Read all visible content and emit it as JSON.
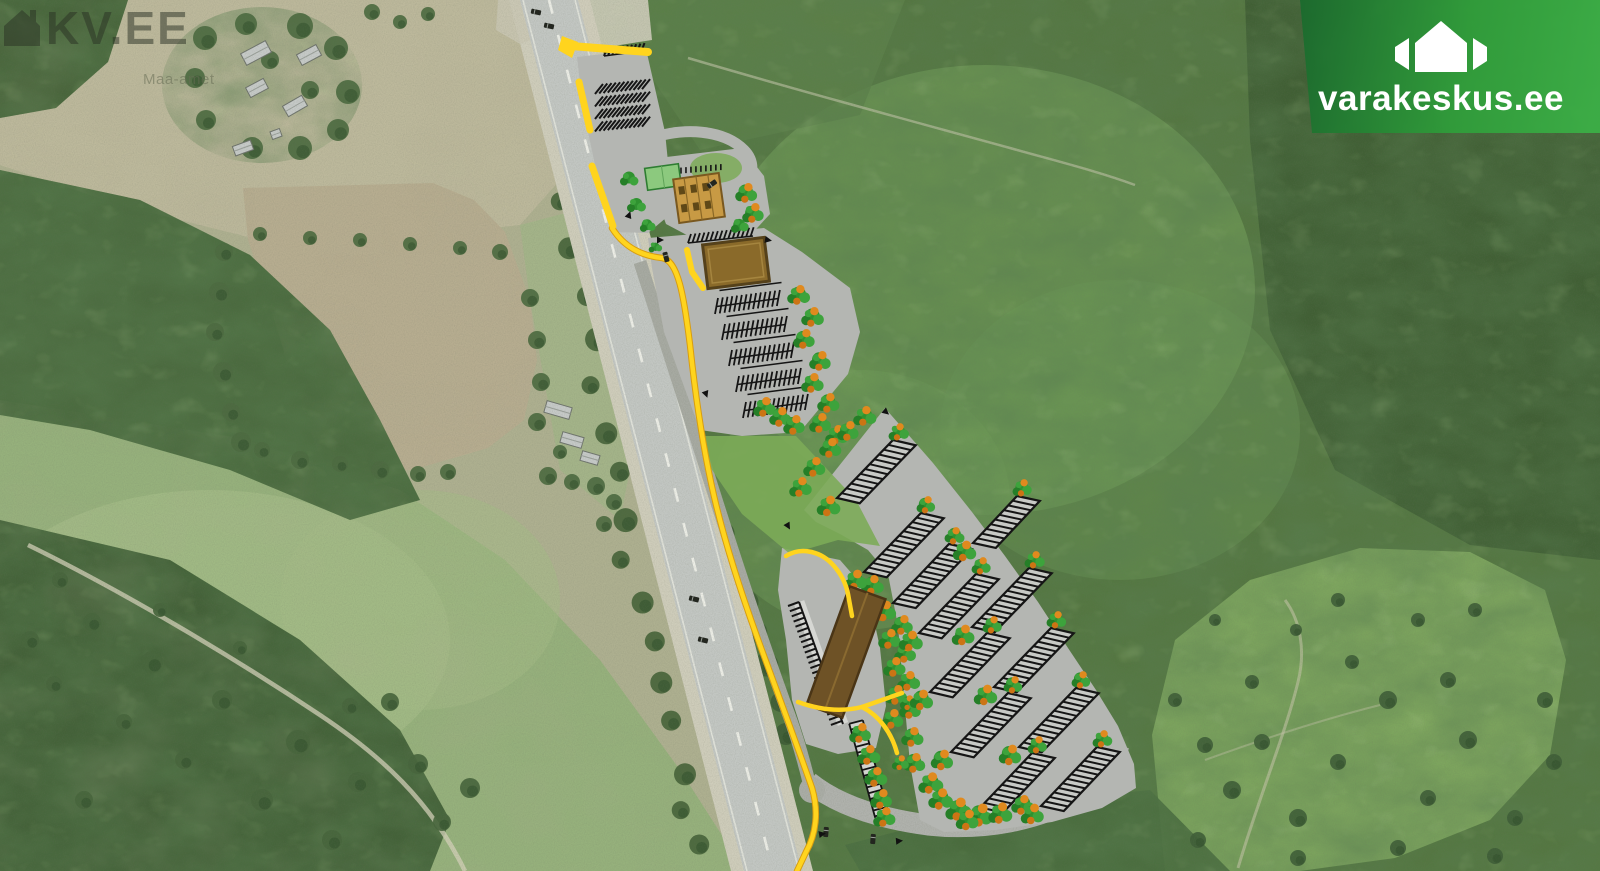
{
  "watermarks": {
    "kv_text": "KV.EE",
    "map_source_text": "Maa-amet"
  },
  "brand": {
    "name": "varakeskus.ee",
    "icon": "varakeskus-house-icon",
    "banner_gradient_start": "#1a6b2d",
    "banner_gradient_mid": "#2f9e3a",
    "banner_gradient_end": "#3bb046"
  },
  "kv": {
    "icon": "kv-house-icon",
    "color": "#2a3124"
  },
  "map_colors": {
    "access_road_yellow": "#ffd41e",
    "parking_asphalt": "#b4b6b2",
    "stall_marking": "#151515",
    "building_brown": "#8a6a2a",
    "long_building_brown": "#6e5226",
    "canopy_tan": "#c89a44",
    "green_roof_building": "#8cc97e",
    "planted_tree_green": "#2f9230",
    "planted_tree_orange": "#e08a1e",
    "plan_lawn_green": "#7cab58",
    "forest_green": "#547741",
    "field_tan": "#b7ad90",
    "meadow_green": "#96b17c",
    "highway_gray": "#c3c7c3"
  }
}
